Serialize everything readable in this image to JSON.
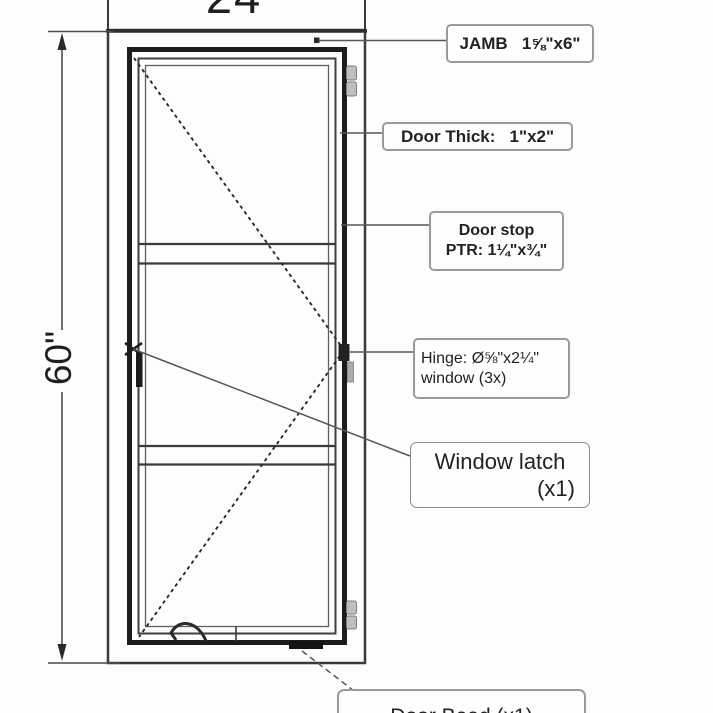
{
  "drawing_title": "door-window-elevation",
  "dimensions": {
    "width_label": "24",
    "height_label": "60\""
  },
  "callouts": {
    "jamb": "JAMB   1⅝\"x6\"",
    "door_thick": "Door Thick:   1\"x2\"",
    "door_stop": [
      "Door stop",
      "PTR: 1¼\"x¾\""
    ],
    "hinge": [
      "Hinge: Ø⅝\"x2¼\"",
      "window (3x)"
    ],
    "window_latch": [
      "Window latch",
      "(x1)"
    ],
    "bottom": "Door Bead (x1)"
  },
  "counts": {
    "hinges": "3x",
    "window_latch": "x1"
  },
  "colors": {
    "line_dark": "#1c1c1c",
    "line_medium": "#3a3a3a",
    "line_light": "#606060",
    "label_border": "#9a9a9a",
    "hinge_fill": "#bfbfbf",
    "background": "#fdfdfd"
  }
}
